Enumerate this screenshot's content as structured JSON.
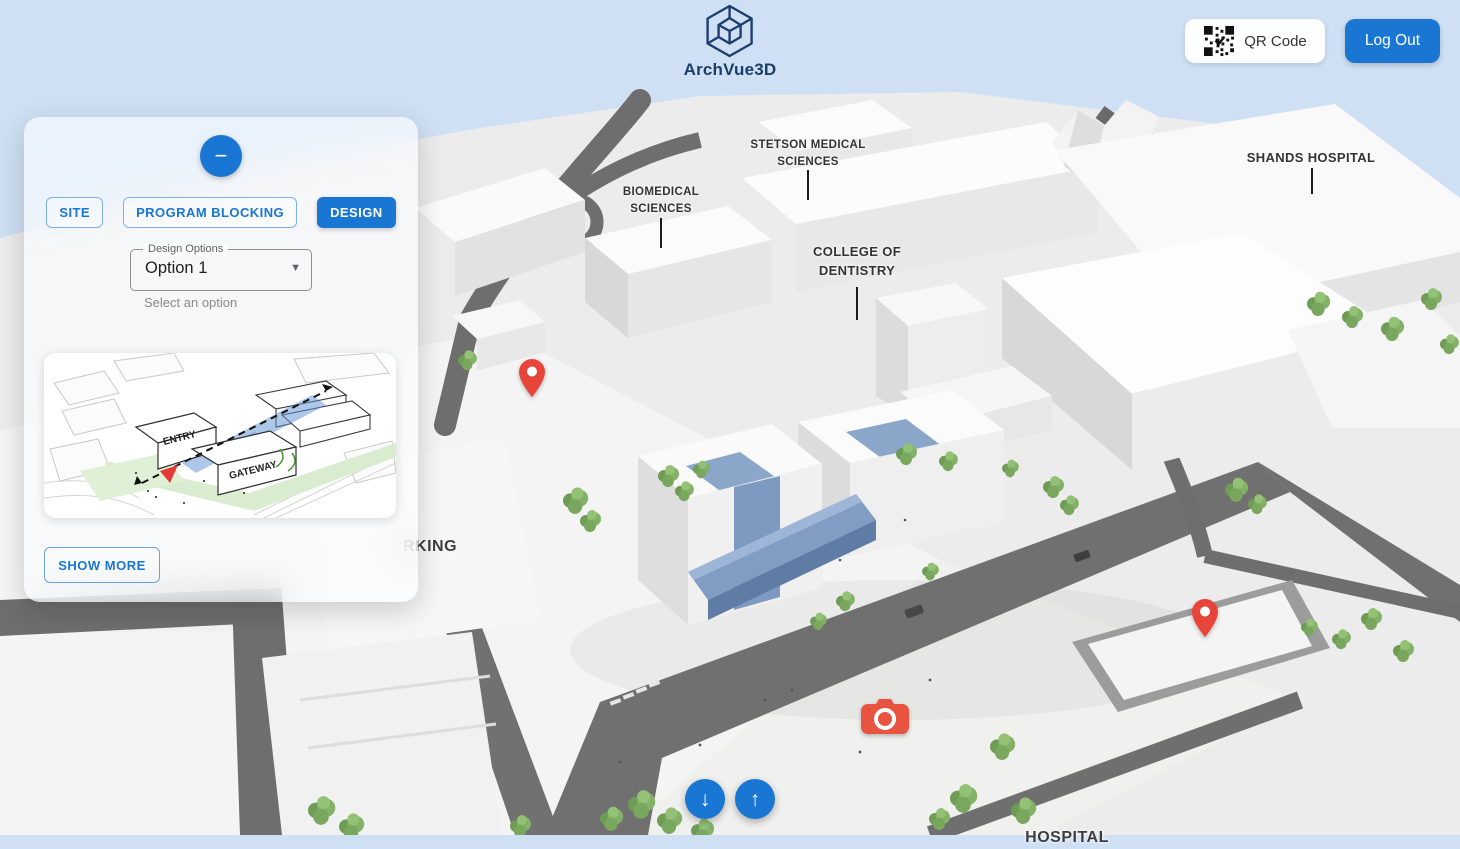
{
  "header": {
    "logo": {
      "text": "ArchVue3D"
    },
    "qr_button": {
      "label": "QR Code"
    },
    "logout_button": {
      "label": "Log Out"
    }
  },
  "panel": {
    "collapse_button": {
      "symbol": "−"
    },
    "tabs": [
      {
        "label": "SITE",
        "active": false
      },
      {
        "label": "PROGRAM BLOCKING",
        "active": false
      },
      {
        "label": "DESIGN",
        "active": true
      }
    ],
    "design_options": {
      "label": "Design Options",
      "value": "Option 1",
      "helper": "Select an option",
      "caret_symbol": "▼"
    },
    "thumbnail": {
      "entry_label": "ENTRY",
      "gateway_label": "GATEWAY"
    },
    "show_more_button": {
      "label": "SHOW MORE"
    }
  },
  "map": {
    "labels": [
      {
        "line1": "STETSON MEDICAL",
        "line2": "SCIENCES"
      },
      {
        "line1": "BIOMEDICAL",
        "line2": "SCIENCES"
      },
      {
        "line1": "COLLEGE OF",
        "line2": "DENTISTRY"
      },
      {
        "line1": "SHANDS HOSPITAL",
        "line2": ""
      },
      {
        "line1": "RKING",
        "line2": ""
      },
      {
        "line1": "HOSPITAL",
        "line2": ""
      }
    ],
    "pins_count": 2,
    "nav": {
      "down_symbol": "↓",
      "up_symbol": "↑"
    }
  },
  "icons": {
    "logo": "hex-cube",
    "qr": "qr-code",
    "collapse": "minus",
    "select_caret": "caret-down",
    "nav_down": "arrow-down",
    "nav_up": "arrow-up",
    "camera": "camera",
    "pin": "map-pin"
  },
  "colors": {
    "accent": "#1976d2",
    "sky": "#cfe0f4",
    "pin_red": "#e8453a",
    "camera_red": "#e8543f",
    "design_blue_band": "#7f9cc2",
    "logo_navy": "#1c3e6b",
    "road_gray": "#6e6e6e",
    "tree_green": "#84b168"
  }
}
